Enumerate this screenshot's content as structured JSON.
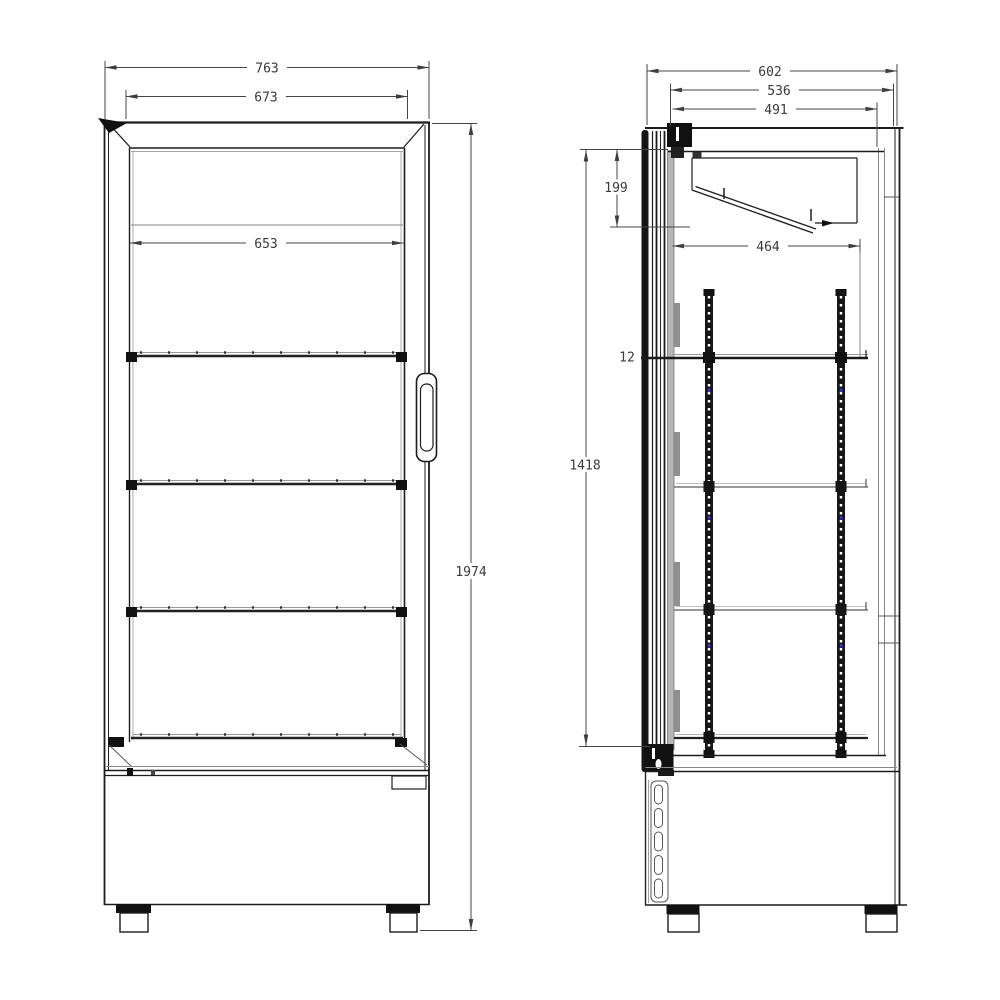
{
  "drawing": {
    "type": "technical dimension drawing of upright glass-door display cooler",
    "front_view": {
      "overall_width": "763",
      "door_frame_width": "673",
      "shelf_width": "653",
      "overall_height": "1974"
    },
    "side_view": {
      "overall_depth": "602",
      "body_depth": "536",
      "door_to_back_depth": "491",
      "top_compartment_height": "199",
      "interior_height": "1418",
      "shelf_thickness": "12",
      "shelf_depth": "464"
    },
    "colors": {
      "background": "#ffffff",
      "object_line": "#1c1c1c",
      "light_line": "#8a8a8a",
      "dimension_line": "#454545",
      "rail_accent_blue": "#3434c8"
    }
  }
}
